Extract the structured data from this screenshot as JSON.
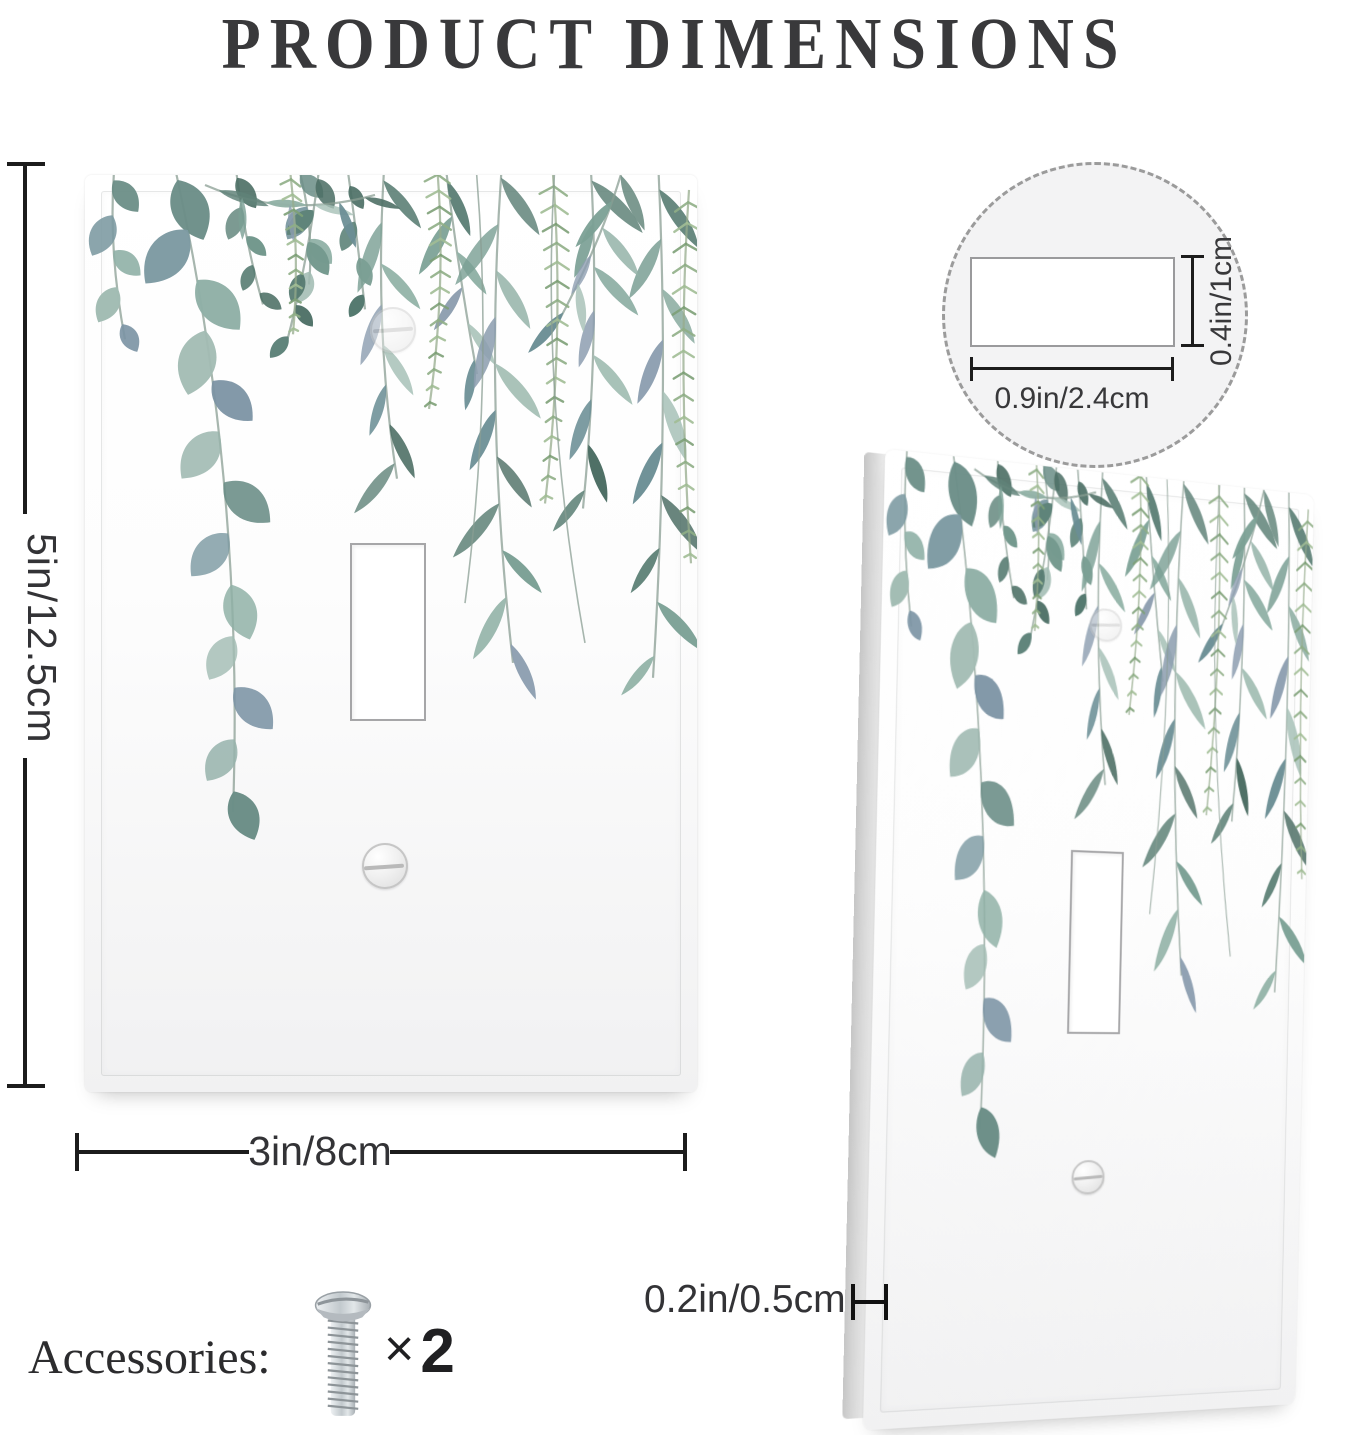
{
  "title": "PRODUCT DIMENSIONS",
  "front_view": {
    "height_label": "5in/12.5cm",
    "width_label": "3in/8cm"
  },
  "side_view": {
    "thickness_label": "0.2in/0.5cm"
  },
  "toggle_hole_detail": {
    "width_label": "0.9in/2.4cm",
    "height_label": "0.4in/1cm"
  },
  "accessories": {
    "label": "Accessories:",
    "times_symbol": "×",
    "quantity": "2"
  },
  "icons": {
    "screw": "screw-icon",
    "detail_callout": "dashed-circle-callout"
  },
  "colors": {
    "dimension_line": "#1c1c1c",
    "dimension_text": "#333336",
    "title_text": "#39393b",
    "leaf_teal": "#6b8e87",
    "leaf_blue_gray": "#8d9eb0",
    "fern_green": "#8fae86",
    "plate_white": "#fdfdfd",
    "edge_gray": "#c6c6c6"
  }
}
